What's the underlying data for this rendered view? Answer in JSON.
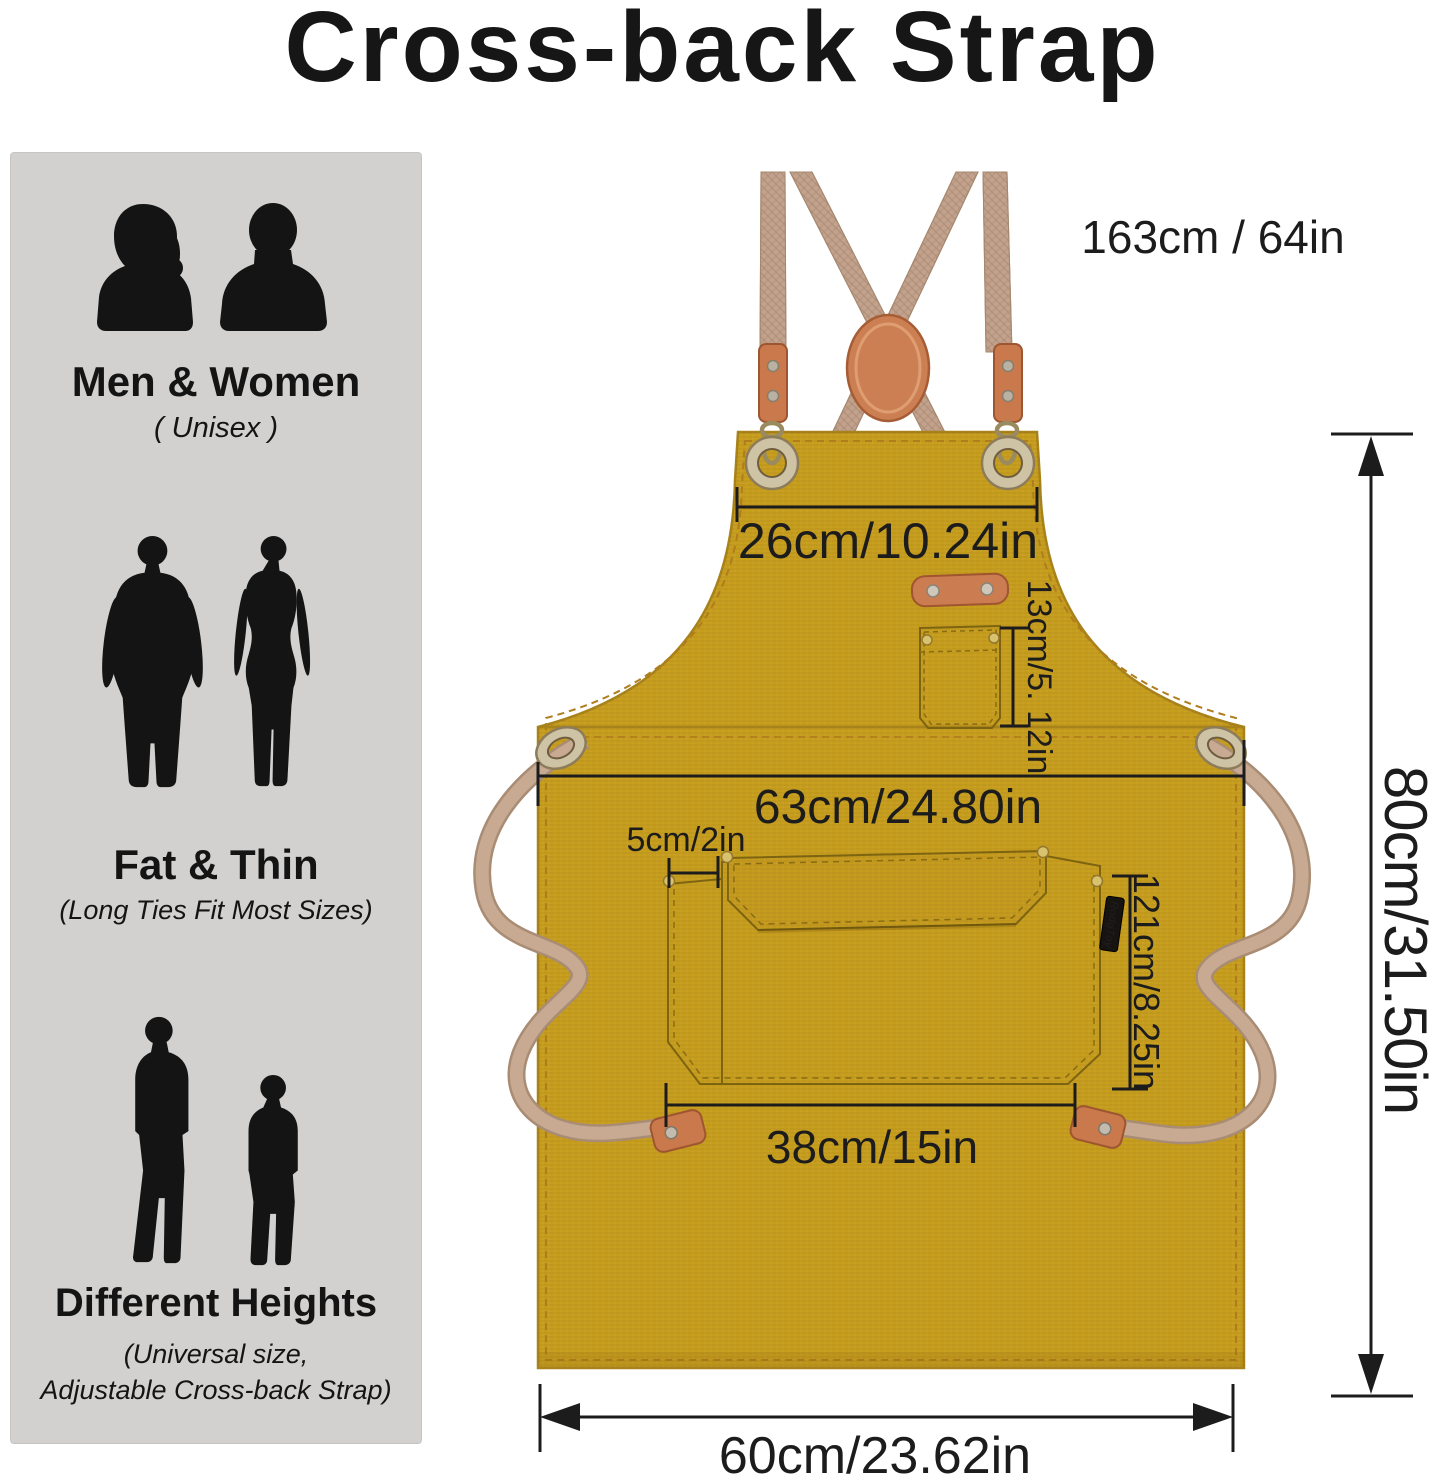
{
  "title": "Cross-back Strap",
  "sidebar": {
    "sections": [
      {
        "heading": "Men & Women",
        "sub": "( Unisex )"
      },
      {
        "heading": "Fat & Thin",
        "sub": "(Long Ties Fit Most Sizes)"
      },
      {
        "heading": "Different Heights",
        "sub": "(Universal size,",
        "sub2": "Adjustable Cross-back Strap)"
      }
    ]
  },
  "diagram": {
    "brand_tag": "RodgToy",
    "measurements": {
      "strap_length": "163cm / 64in",
      "bib_width": "26cm/10.24in",
      "chest_pocket_height": "13cm/5. 12in",
      "waist_width": "63cm/24.80in",
      "pocket_offset": "5cm/2in",
      "pocket_height": "121cm/8.25in",
      "pocket_width": "38cm/15in",
      "apron_height": "80cm/31.50in",
      "bottom_width": "60cm/23.62in"
    },
    "colors": {
      "apron": "#c79d1e",
      "strap": "#c2a28c",
      "leather": "#c9794c",
      "panel": "#d2d1d0",
      "dimension": "#1c1c1c"
    }
  }
}
